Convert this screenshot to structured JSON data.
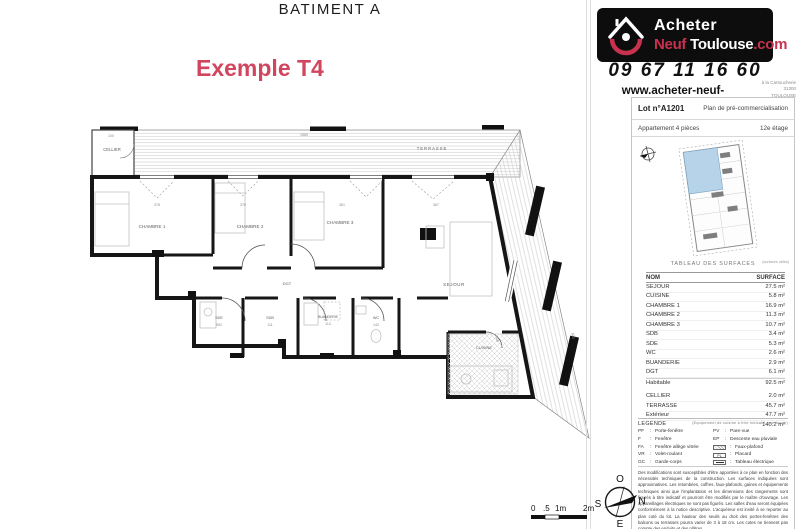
{
  "header": {
    "building_title": "BATIMENT A",
    "example_label": "Exemple T4"
  },
  "branding": {
    "logo_acheter": "Acheter",
    "logo_neuf": "Neuf",
    "logo_toulouse": "Toulouse",
    "logo_com": ".com",
    "phone": "09 67 11 16 60",
    "website": "www.acheter-neuf-toulouse.com",
    "address_line1": "à la Cartoucherie",
    "address_line2": "31300",
    "address_line3": "TOULOUSE"
  },
  "lot_panel": {
    "lot_number": "Lot n°A1201",
    "plan_type": "Plan de pré-commercialisation",
    "apartment_type": "Appartement 4 pièces",
    "floor": "12e étage"
  },
  "surface_table": {
    "title": "TABLEAU DES SURFACES",
    "note": "(surfaces utiles)",
    "header": {
      "name": "NOM",
      "surface": "SURFACE"
    },
    "rows": [
      {
        "name": "SEJOUR",
        "surface": "27.5 m²"
      },
      {
        "name": "CUISINE",
        "surface": "5.8 m²"
      },
      {
        "name": "CHAMBRE 1",
        "surface": "16.9 m²"
      },
      {
        "name": "CHAMBRE 2",
        "surface": "11.3 m²"
      },
      {
        "name": "CHAMBRE 3",
        "surface": "10.7 m²"
      },
      {
        "name": "SDB",
        "surface": "3.4 m²"
      },
      {
        "name": "SDE",
        "surface": "5.3 m²"
      },
      {
        "name": "WC",
        "surface": "2.6 m²"
      },
      {
        "name": "BUANDERIE",
        "surface": "2.9 m²"
      },
      {
        "name": "DGT",
        "surface": "6.1 m²"
      }
    ],
    "subtotal": {
      "name": "Habitable",
      "surface": "92.5 m²"
    },
    "exterior_rows": [
      {
        "name": "CELLIER",
        "surface": "2.0 m²"
      },
      {
        "name": "TERRASSE",
        "surface": "45.7 m²"
      },
      {
        "name": "Extérieur",
        "surface": "47.7 m²"
      }
    ],
    "total": "140.2 m²"
  },
  "legend": {
    "title": "LEGENDE",
    "note": "(Equipement de cuisine à titre indicatif, non fourni)",
    "separator": ":",
    "left": [
      {
        "abbr": "PF",
        "label": "Porte-fenêtre"
      },
      {
        "abbr": "F",
        "label": "Fenêtre"
      },
      {
        "abbr": "FA",
        "label": "Fenêtre allège vitrée"
      },
      {
        "abbr": "VR",
        "label": "Volet-roulant"
      },
      {
        "abbr": "GC",
        "label": "Garde-corps"
      }
    ],
    "right": [
      {
        "abbr": "PV",
        "label": "Pare-vue"
      },
      {
        "abbr": "EP",
        "label": "Descente eau pluviale"
      }
    ],
    "swatches": [
      {
        "label": "Faux-plafond"
      },
      {
        "label": "Placard",
        "abbr": "PL"
      },
      {
        "label": "Tableau électrique"
      }
    ]
  },
  "disclaimer": "Des modifications sont susceptibles d'être apportées à ce plan en fonction des nécessités techniques de la construction. Les surfaces indiquées sont approximatives. Les retombées, coffres, faux-plafonds, gaines et équipements techniques ainsi que l'implantation et les dimensions des rangements sont figurés à titre indicatif et pourront être modifiés par le maître d'ouvrage. Les appareillages électriques ne sont pas figurés. Les salles d'eau seront équipées conformément à la notice descriptive. L'acquéreur est invité à se reporter au plan coté du lot. La hauteur des seuils au droit des portes-fenêtres des balcons ou terrasses pourra varier de 3 à 18 cm. Les cotes ne tiennent pas compte des enduits et des plâtres.",
  "plan": {
    "labels": {
      "cellier": "CELLIER",
      "terrasse": "TERRASSE",
      "chambre1": "CHAMBRE 1",
      "chambre2": "CHAMBRE 2",
      "chambre3": "CHAMBRE 3",
      "sejour": "SEJOUR",
      "dgt": "DGT",
      "sde": "SDE",
      "sdb": "SDB",
      "buanderie": "BUANDERIE",
      "wc": "WC",
      "cuisine": "CUISINE"
    },
    "dims": {
      "terrace_len": "1565",
      "cellier_w": "100",
      "win1": "378",
      "win2": "370",
      "win3": "361",
      "win4": "367",
      "sde_n": "552",
      "sdb_n": "111",
      "buanderie_n": "113",
      "wc_n": "142",
      "sejour_h": "608",
      "terrace_diag": "603"
    }
  },
  "scale_bar": {
    "l0": "0",
    "l1": ".5",
    "l2": "1m",
    "l3": "2m"
  },
  "compass": {
    "n": "N",
    "e": "E",
    "s": "S",
    "o": "O"
  },
  "colors": {
    "brand_red": "#c8324e",
    "lot_highlight_blue": "#b7d3ea",
    "title_red": "#d1455f"
  }
}
